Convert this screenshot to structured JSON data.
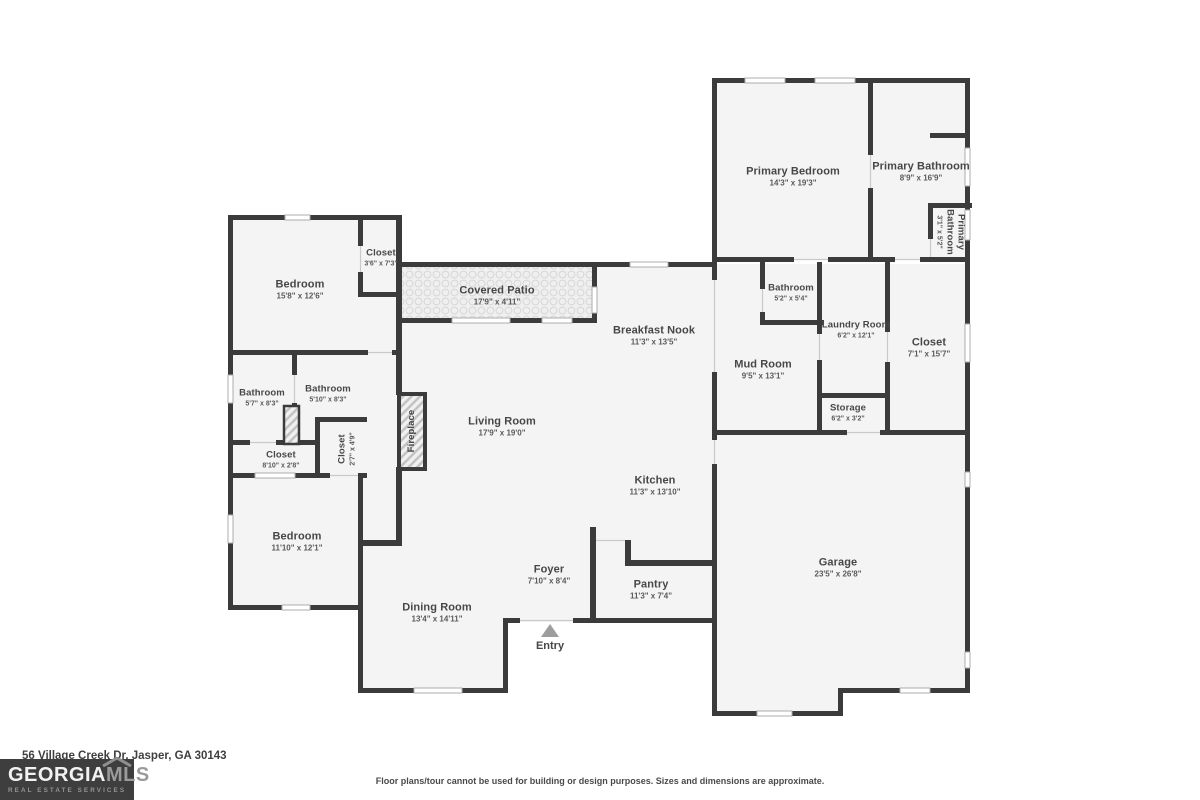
{
  "meta": {
    "address": "56 Village Creek Dr, Jasper, GA 30143",
    "disclaimer": "Floor plans/tour cannot be used for building or design purposes. Sizes and dimensions are approximate."
  },
  "logo": {
    "brand_primary": "GEORGIA",
    "brand_secondary": "MLS",
    "tagline": "REAL ESTATE SERVICES"
  },
  "colors": {
    "wall": "#3b3b3b",
    "room_fill": "#f4f4f4",
    "label_text": "#474747",
    "logo_background": "#3e3e3e"
  },
  "markers": {
    "entry_label": "Entry"
  },
  "rooms": [
    {
      "id": "primary-bedroom",
      "name": "Primary Bedroom",
      "dims": "14'3\" x 19'3\""
    },
    {
      "id": "primary-bathroom",
      "name": "Primary Bathroom",
      "dims": "8'9\" x 16'9\""
    },
    {
      "id": "primary-water-closet",
      "name": "Primary Bathroom",
      "dims": "3'1\" x 5'2\""
    },
    {
      "id": "bedroom-upper-left",
      "name": "Bedroom",
      "dims": "15'8\" x 12'6\""
    },
    {
      "id": "closet-upper-left",
      "name": "Closet",
      "dims": "3'6\" x 7'3\""
    },
    {
      "id": "covered-patio",
      "name": "Covered Patio",
      "dims": "17'9\" x 4'11\""
    },
    {
      "id": "breakfast-nook",
      "name": "Breakfast Nook",
      "dims": "11'3\" x 13'5\""
    },
    {
      "id": "bathroom-mud",
      "name": "Bathroom",
      "dims": "5'2\" x 5'4\""
    },
    {
      "id": "laundry-room",
      "name": "Laundry Room",
      "dims": "6'2\" x 12'1\""
    },
    {
      "id": "mud-room",
      "name": "Mud Room",
      "dims": "9'5\" x 13'1\""
    },
    {
      "id": "closet-primary",
      "name": "Closet",
      "dims": "7'1\" x 15'7\""
    },
    {
      "id": "storage",
      "name": "Storage",
      "dims": "6'2\" x 3'2\""
    },
    {
      "id": "living-room",
      "name": "Living Room",
      "dims": "17'9\" x 19'0\""
    },
    {
      "id": "fireplace",
      "name": "Fireplace",
      "dims": ""
    },
    {
      "id": "bathroom-left-1",
      "name": "Bathroom",
      "dims": "5'7\" x 8'3\""
    },
    {
      "id": "bathroom-left-2",
      "name": "Bathroom",
      "dims": "5'10\" x 8'3\""
    },
    {
      "id": "closet-hall",
      "name": "Closet",
      "dims": "8'10\" x 2'8\""
    },
    {
      "id": "closet-small",
      "name": "Closet",
      "dims": "2'7\" x 4'9\""
    },
    {
      "id": "bedroom-lower-left",
      "name": "Bedroom",
      "dims": "11'10\" x 12'1\""
    },
    {
      "id": "kitchen",
      "name": "Kitchen",
      "dims": "11'3\" x 13'10\""
    },
    {
      "id": "foyer",
      "name": "Foyer",
      "dims": "7'10\" x 8'4\""
    },
    {
      "id": "pantry",
      "name": "Pantry",
      "dims": "11'3\" x 7'4\""
    },
    {
      "id": "dining-room",
      "name": "Dining Room",
      "dims": "13'4\" x 14'11\""
    },
    {
      "id": "garage",
      "name": "Garage",
      "dims": "23'5\" x 26'8\""
    },
    {
      "id": "entry",
      "name": "Entry",
      "dims": ""
    }
  ]
}
